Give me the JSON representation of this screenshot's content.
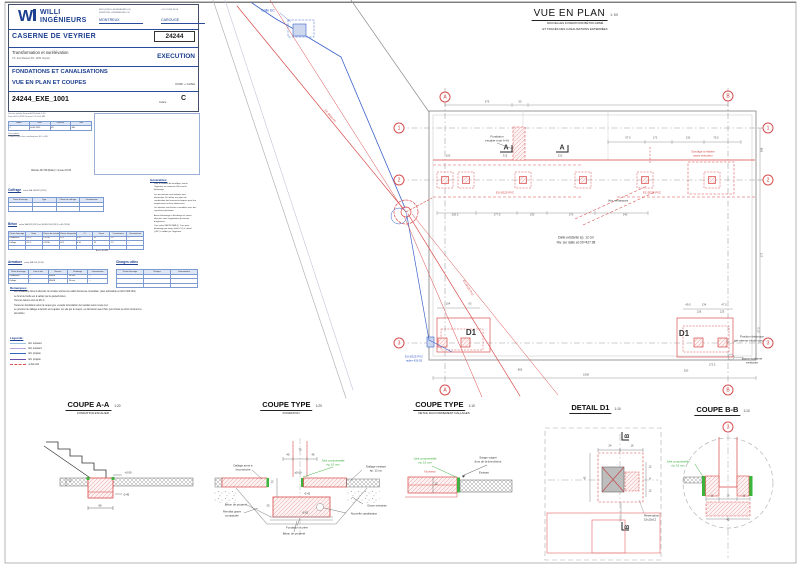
{
  "title_block": {
    "company_line1": "WILLI",
    "company_line2": "INGÉNIEURS",
    "contact_email": "INFO@WILLI-INGENIEURS.CH",
    "contact_web": "WWW.WILLI-INGENIEURS.CH",
    "contact_phone": "+41 21 963 44 66",
    "office_left": "MONTREUX",
    "office_right": "CAROUGE",
    "project_name": "CASERNE DE VEYRIER",
    "project_number": "24244",
    "project_desc": "Transformation et surélévation",
    "project_address": "Ch. des Rasses 84, 1255 Veyrier",
    "phase": "EXECUTION",
    "doc_title1": "FONDATIONS ET CANALISATIONS",
    "doc_title2": "VUE EN PLAN ET COUPES",
    "doc_type": "COFF + CANA",
    "doc_number": "24244_EXE_1001",
    "indice_label": "Indice",
    "indice": "C",
    "meta1": "Version initiale      Format A1      Échelle 1:50",
    "meta2": "Date 06.10.2022      Dessiné VD      Visé MB",
    "revision": {
      "headers": [
        "Indice",
        "Date",
        "Dessiné",
        "Visé"
      ],
      "rows": [
        [
          "C",
          "04.04.2023",
          "VD",
          "MB"
        ]
      ],
      "empty": 0
    },
    "description_label": "Description:",
    "description_item": "C   Mise à jour des canalisations EC et EU",
    "altitude_note": "Altitude 427.98 (Dalle) = niveau ±0.00"
  },
  "tables": {
    "coffrage": {
      "title": "Coffrage",
      "norm": "selon SIA 118/262 (2013)",
      "headers": [
        "Partie d'ouvrage",
        "Type",
        "Classe de coffrage",
        "Commentaire"
      ],
      "rows": [],
      "empty": 2
    },
    "beton": {
      "title": "Béton",
      "norm": "selon SIA 262 (2013) et SN EN 206 (2013) + A1 (2016)",
      "headers": [
        "Partie d'ouvrage",
        "Sorte",
        "Classe de résistance",
        "Classe d'exposition",
        "Cl",
        "Dmax",
        "Consistance",
        "Commentaire"
      ],
      "rows": [
        [
          "Fondations",
          "RC-C",
          "C25/30",
          "XC2",
          "0.10",
          "32",
          "C3",
          "—"
        ],
        [
          "Dallage",
          "RC-C",
          "C25/30",
          "XC2",
          "0.10",
          "32",
          "C3",
          "—"
        ]
      ],
      "empty": 1
    },
    "armature": {
      "title": "Armature",
      "norm": "selon SIA 262 (2013)",
      "unit": "Acier: B500B",
      "headers": [
        "Partie d'ouvrage",
        "Lots et fers",
        "Nuance",
        "Enrobage",
        "Commentaire"
      ],
      "rows": [
        [
          "Fondations",
          "—",
          "B500B",
          "30 mm",
          "—"
        ],
        [
          "Dallage",
          "—",
          "B500B",
          "30 mm",
          "—"
        ]
      ],
      "empty": 0
    },
    "charges": {
      "title": "Charges utiles",
      "norm": "selon SIA 261 (2014)",
      "headers": [
        "Partie d'ouvrage",
        "Charges",
        "Commentaire"
      ],
      "rows": [],
      "empty": 3
    }
  },
  "generalites": {
    "title": "Généralités:",
    "items": [
      "Pour le contrôle du ferraillage, avertir l'ingénieur au minimum 24h avant le bétonnage.",
      "Les percements sont indiqués pour information. Se référer aux plans de coordination des bureaux techniques pour leur emplacement et leurs dimensions.",
      "Les attentes sont livrées et enrobées avec des capuchons plastiques.",
      "Aucun bétonnage ni décoffrage ne seront effectués sans l'approbation du bureau d'ingénieurs.",
      "Cure selon SIA 262 NBB (!). Cure pour bétonnage par temps froid (<5°) et chaud (>30°) à valider par l'ingénieur."
    ]
  },
  "remarques": {
    "title": "Remarques:",
    "items": [
      "Les fondations doivent atteindre la moraine würmienne sablo-limoneuse consolidée. (taux admissible en ELU=400 kPa)",
      "Le fond de fouille est à valider par le géotechnicien.",
      "Tous les bétons sont du RC-C",
      "Toutes les fondations selon la coupe type, excepté la fondation de l'escalier selon coupe A-A",
      "Le pourtour du dallage à démolir est à ajuster sur site par le maçon, en discussion avec l'EG, pour limiter au strict minimum la démolition"
    ]
  },
  "legende": {
    "title": "Légende:",
    "items": [
      {
        "label": "EC existant",
        "color": "#9bc3e6",
        "style": "solid"
      },
      {
        "label": "EU existant",
        "color": "#b9a7d8",
        "style": "solid"
      },
      {
        "label": "EC projeté",
        "color": "#2f66c4",
        "style": "solid"
      },
      {
        "label": "EU projeté",
        "color": "#6a51a8",
        "style": "solid"
      },
      {
        "label": "à démolir",
        "color": "#d85050",
        "style": "dashdot"
      }
    ]
  },
  "plan": {
    "title": "VUE EN PLAN",
    "scale": "1:50",
    "subtitle1": "NOUVELLES FONDATIONS BÉTON ARMÉ",
    "subtitle2": "ET TRACÉS DES CANALISATIONS ENTERRÉES",
    "bubbles": [
      {
        "t": "A",
        "x": 445,
        "y": 97
      },
      {
        "t": "B",
        "x": 728,
        "y": 96
      },
      {
        "t": "1",
        "x": 399,
        "y": 128
      },
      {
        "t": "2",
        "x": 399,
        "y": 180
      },
      {
        "t": "3",
        "x": 399,
        "y": 343
      },
      {
        "t": "1",
        "x": 768,
        "y": 128
      },
      {
        "t": "2",
        "x": 768,
        "y": 180
      },
      {
        "t": "3",
        "x": 768,
        "y": 343
      },
      {
        "t": "A",
        "x": 445,
        "y": 390
      },
      {
        "t": "B",
        "x": 728,
        "y": 390
      },
      {
        "t": "3",
        "x": 728,
        "y": 427
      }
    ],
    "labels": [
      {
        "t": "Grille EC",
        "x": 268,
        "y": 11,
        "c": "blue",
        "s": 3.4
      },
      {
        "t": "Fondation",
        "x": 497,
        "y": 137,
        "s": 3
      },
      {
        "t": "escalier (voir A-A)",
        "x": 497,
        "y": 141,
        "s": 3
      },
      {
        "t": "A",
        "x": 506,
        "y": 148,
        "s": 7,
        "b": 1
      },
      {
        "t": "A",
        "x": 562,
        "y": 148,
        "s": 7,
        "b": 1
      },
      {
        "t": "Voir remarques",
        "x": 618,
        "y": 201,
        "s": 3
      },
      {
        "t": "Sondage à réaliser",
        "x": 703,
        "y": 152,
        "c": "red",
        "s": 2.8
      },
      {
        "t": "avant exécution",
        "x": 703,
        "y": 156,
        "c": "red",
        "s": 2.8
      },
      {
        "t": "EU Ø125 PVC",
        "x": 505,
        "y": 193,
        "c": "red",
        "s": 2.8
      },
      {
        "t": "EC Ø125 PVC",
        "x": 652,
        "y": 193,
        "c": "red",
        "s": 2.8
      },
      {
        "t": "Dalle existante ép. 12 cm",
        "x": 576,
        "y": 238,
        "s": 3.2
      },
      {
        "t": "Niv. sur dalle ±0.00=427.98",
        "x": 576,
        "y": 243,
        "s": 3.2
      },
      {
        "t": "D1",
        "x": 471,
        "y": 333,
        "s": 8,
        "b": 1
      },
      {
        "t": "D1",
        "x": 684,
        "y": 334,
        "s": 8,
        "b": 1
      },
      {
        "t": "Position théorique",
        "x": 752,
        "y": 337,
        "s": 3
      },
      {
        "t": "(en attente étude sondage)",
        "x": 752,
        "y": 341,
        "s": 3
      },
      {
        "t": "Borne hydrante",
        "x": 752,
        "y": 359,
        "s": 3
      },
      {
        "t": "existante",
        "x": 752,
        "y": 363,
        "s": 3
      },
      {
        "t": "EU Ø125 PVC",
        "x": 414,
        "y": 357,
        "c": "blue",
        "s": 2.8
      },
      {
        "t": "radier 426.55",
        "x": 414,
        "y": 361,
        "c": "blue",
        "s": 2.8
      },
      {
        "t": "EC Ø160 PE",
        "x": 330,
        "y": 116,
        "c": "red",
        "s": 2.8,
        "r": 50
      },
      {
        "t": "EU Ø125 PVC",
        "x": 468,
        "y": 288,
        "c": "red",
        "s": 2.8,
        "r": 58
      }
    ],
    "dims": [
      {
        "t": "575",
        "x": 487,
        "y": 103
      },
      {
        "t": "50",
        "x": 520,
        "y": 103
      },
      {
        "t": "97.5",
        "x": 628,
        "y": 139
      },
      {
        "t": "172",
        "x": 655,
        "y": 139
      },
      {
        "t": "130",
        "x": 688,
        "y": 139
      },
      {
        "t": "75.5",
        "x": 716,
        "y": 139
      },
      {
        "t": "100",
        "x": 448,
        "y": 157
      },
      {
        "t": "315",
        "x": 505,
        "y": 157
      },
      {
        "t": "310",
        "x": 560,
        "y": 157
      },
      {
        "t": "200.5",
        "x": 455,
        "y": 216
      },
      {
        "t": "177.5",
        "x": 497,
        "y": 216
      },
      {
        "t": "130",
        "x": 532,
        "y": 216
      },
      {
        "t": "170",
        "x": 571,
        "y": 216
      },
      {
        "t": "140",
        "x": 625,
        "y": 216
      },
      {
        "t": "104",
        "x": 448,
        "y": 305
      },
      {
        "t": "63",
        "x": 470,
        "y": 305
      },
      {
        "t": "49.5",
        "x": 688,
        "y": 306
      },
      {
        "t": "134",
        "x": 704,
        "y": 306
      },
      {
        "t": "47.5",
        "x": 724,
        "y": 306
      },
      {
        "t": "126",
        "x": 699,
        "y": 313
      },
      {
        "t": "125",
        "x": 722,
        "y": 313
      },
      {
        "t": "865",
        "x": 520,
        "y": 371
      },
      {
        "t": "1506",
        "x": 586,
        "y": 376
      },
      {
        "t": "250",
        "x": 686,
        "y": 372
      },
      {
        "t": "173.5",
        "x": 712,
        "y": 366
      },
      {
        "t": "298",
        "x": 763,
        "y": 150,
        "r": -90
      },
      {
        "t": "171",
        "x": 763,
        "y": 255,
        "r": -90
      },
      {
        "t": "57.5",
        "x": 760,
        "y": 330,
        "r": -90
      }
    ]
  },
  "sections": [
    {
      "title": "COUPE A-A",
      "scale": "1:20",
      "subtitle": "FONDATION ESCALIER"
    },
    {
      "title": "COUPE TYPE",
      "scale": "1:20",
      "subtitle": "FONDATION"
    },
    {
      "title": "COUPE TYPE",
      "scale": "1:10",
      "subtitle": "DETAIL RACCORDEMENT DALLAGES"
    },
    {
      "title": "DETAIL D1",
      "scale": "1:10",
      "subtitle": ""
    },
    {
      "title": "COUPE B-B",
      "scale": "1:10",
      "subtitle": ""
    }
  ],
  "section_labels": [
    {
      "t": "+0.00",
      "x": 128,
      "y": 473,
      "s": 2.8
    },
    {
      "t": "-0.45",
      "x": 126,
      "y": 495,
      "s": 2.8
    },
    {
      "t": "60",
      "x": 100,
      "y": 506,
      "s": 2.8
    },
    {
      "t": "12",
      "x": 70,
      "y": 482,
      "s": 2.6
    },
    {
      "t": "Dallage armé à",
      "x": 243,
      "y": 466,
      "s": 2.8
    },
    {
      "t": "reconstruire",
      "x": 243,
      "y": 470,
      "s": 2.8
    },
    {
      "t": "Joint compressible",
      "x": 333,
      "y": 461,
      "c": "green",
      "s": 2.8
    },
    {
      "t": "ép. 10 mm",
      "x": 333,
      "y": 465,
      "c": "green",
      "s": 2.8
    },
    {
      "t": "Dallage existant",
      "x": 376,
      "y": 467,
      "s": 2.8
    },
    {
      "t": "ép. 12 cm",
      "x": 376,
      "y": 471,
      "s": 2.8
    },
    {
      "t": "±0.00",
      "x": 298,
      "y": 473,
      "s": 2.8
    },
    {
      "t": "-0.42",
      "x": 307,
      "y": 494,
      "s": 2.8
    },
    {
      "t": "-0.62",
      "x": 305,
      "y": 513,
      "s": 2.8
    },
    {
      "t": "Grave existante",
      "x": 377,
      "y": 506,
      "s": 2.8
    },
    {
      "t": "Nouvelle canalisation",
      "x": 364,
      "y": 514,
      "s": 2.8
    },
    {
      "t": "Béton de propreté",
      "x": 236,
      "y": 505,
      "s": 2.8
    },
    {
      "t": "Remblai grave",
      "x": 232,
      "y": 512,
      "s": 2.8
    },
    {
      "t": "compactée",
      "x": 232,
      "y": 516,
      "s": 2.8
    },
    {
      "t": "Fondation à créer",
      "x": 297,
      "y": 528,
      "s": 2.8
    },
    {
      "t": "Béton de propreté",
      "x": 294,
      "y": 534,
      "s": 2.8
    },
    {
      "t": "45",
      "x": 288,
      "y": 456,
      "s": 2.6
    },
    {
      "t": "75",
      "x": 300,
      "y": 451,
      "s": 2.6
    },
    {
      "t": "45",
      "x": 313,
      "y": 456,
      "s": 2.6
    },
    {
      "t": "12",
      "x": 272,
      "y": 483,
      "s": 2.6
    },
    {
      "t": "20",
      "x": 268,
      "y": 507,
      "s": 2.6
    },
    {
      "t": "Joint compressible",
      "x": 425,
      "y": 459,
      "c": "green",
      "s": 2.8
    },
    {
      "t": "ép. 10 mm",
      "x": 425,
      "y": 463,
      "c": "green",
      "s": 2.8
    },
    {
      "t": "Sciage soigné",
      "x": 488,
      "y": 458,
      "s": 2.8
    },
    {
      "t": "(lors de la démolition)",
      "x": 488,
      "y": 462,
      "s": 2.8
    },
    {
      "t": "Nouveau",
      "x": 430,
      "y": 472,
      "c": "red",
      "s": 2.8
    },
    {
      "t": "Existant",
      "x": 484,
      "y": 473,
      "s": 2.8
    },
    {
      "t": "12",
      "x": 436,
      "y": 485,
      "s": 2.6
    },
    {
      "t": "B",
      "x": 628,
      "y": 436,
      "s": 6,
      "b": 1,
      "r": -90
    },
    {
      "t": "B",
      "x": 628,
      "y": 527,
      "s": 6,
      "b": 1,
      "r": -90
    },
    {
      "t": "Réservation",
      "x": 644,
      "y": 516,
      "s": 2.8,
      "a": "l"
    },
    {
      "t": "15x15x12",
      "x": 644,
      "y": 520,
      "s": 2.8,
      "a": "l"
    },
    {
      "t": "24",
      "x": 610,
      "y": 447,
      "s": 2.6
    },
    {
      "t": "16",
      "x": 632,
      "y": 447,
      "s": 2.6
    },
    {
      "t": "42",
      "x": 586,
      "y": 478,
      "s": 2.6,
      "r": -90
    },
    {
      "t": "12",
      "x": 650,
      "y": 468,
      "s": 2.6
    },
    {
      "t": "8",
      "x": 650,
      "y": 480,
      "s": 2.6
    },
    {
      "t": "12",
      "x": 650,
      "y": 492,
      "s": 2.6
    },
    {
      "t": "Joint compressible",
      "x": 678,
      "y": 462,
      "c": "green",
      "s": 2.8
    },
    {
      "t": "ép. 10 mm",
      "x": 678,
      "y": 466,
      "c": "green",
      "s": 2.8
    },
    {
      "t": "11",
      "x": 712,
      "y": 497,
      "s": 2.6
    },
    {
      "t": "16",
      "x": 728,
      "y": 497,
      "s": 2.6
    },
    {
      "t": "11",
      "x": 744,
      "y": 497,
      "s": 2.6
    },
    {
      "t": "42",
      "x": 728,
      "y": 521,
      "s": 2.6
    }
  ]
}
